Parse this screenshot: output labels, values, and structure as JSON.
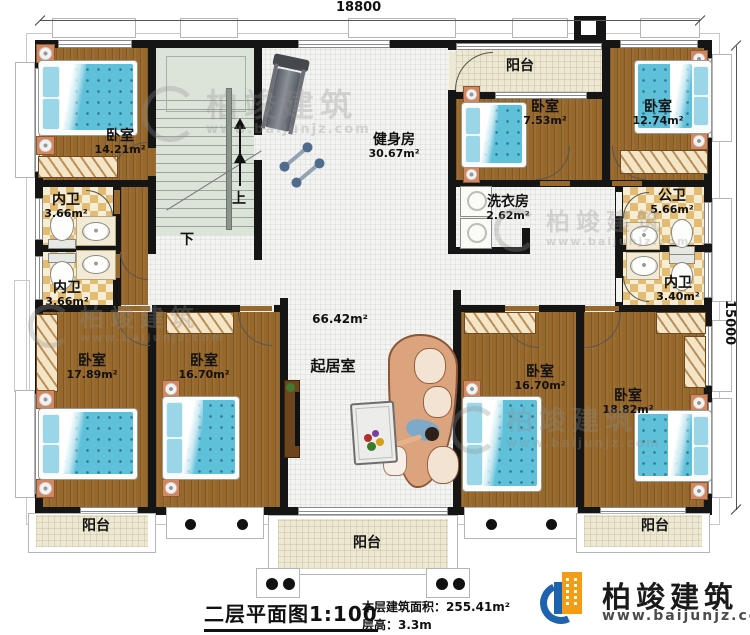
{
  "dimensions": {
    "width_label": "18800",
    "height_label": "15000"
  },
  "rooms": {
    "bedroom_top_left": {
      "name": "卧室",
      "area": "14.21m²"
    },
    "bedroom_top_mid": {
      "name": "卧室",
      "area": "7.53m²"
    },
    "bedroom_top_right": {
      "name": "卧室",
      "area": "12.74m²"
    },
    "gym": {
      "name": "健身房",
      "area": "30.67m²"
    },
    "laundry": {
      "name": "洗衣房",
      "area": "2.62m²"
    },
    "bath_inner_left_top": {
      "name": "内卫",
      "area": "3.66m²"
    },
    "bath_inner_left_bottom": {
      "name": "内卫",
      "area": "3.66m²"
    },
    "bath_public": {
      "name": "公卫",
      "area": "5.66m²"
    },
    "bath_inner_right": {
      "name": "内卫",
      "area": "3.40m²"
    },
    "living": {
      "name": "起居室",
      "area": "66.42m²"
    },
    "bedroom_bottom_left": {
      "name": "卧室",
      "area": "17.89m²"
    },
    "bedroom_bottom_mid_left": {
      "name": "卧室",
      "area": "16.70m²"
    },
    "bedroom_bottom_mid_right": {
      "name": "卧室",
      "area": "16.70m²"
    },
    "bedroom_bottom_right": {
      "name": "卧室",
      "area": "18.82m²"
    },
    "balcony_top": {
      "name": "阳台"
    },
    "balcony_bottom_left": {
      "name": "阳台"
    },
    "balcony_bottom_center": {
      "name": "阳台"
    },
    "balcony_bottom_right": {
      "name": "阳台"
    }
  },
  "stairs": {
    "up": "上",
    "down": "下"
  },
  "titleblock": {
    "title": "二层平面图1:100",
    "area_line": "本层建筑面积：255.41m²",
    "height_line": "层高：3.3m"
  },
  "brand": {
    "name": "柏竣建筑",
    "url": "www.baijunjz.com"
  },
  "watermark": {
    "name": "柏竣建筑",
    "url": "www.baijunjz.com"
  },
  "colors": {
    "brand_blue": "#1e63ad",
    "brand_orange": "#f49c16",
    "wall": "#151515"
  }
}
